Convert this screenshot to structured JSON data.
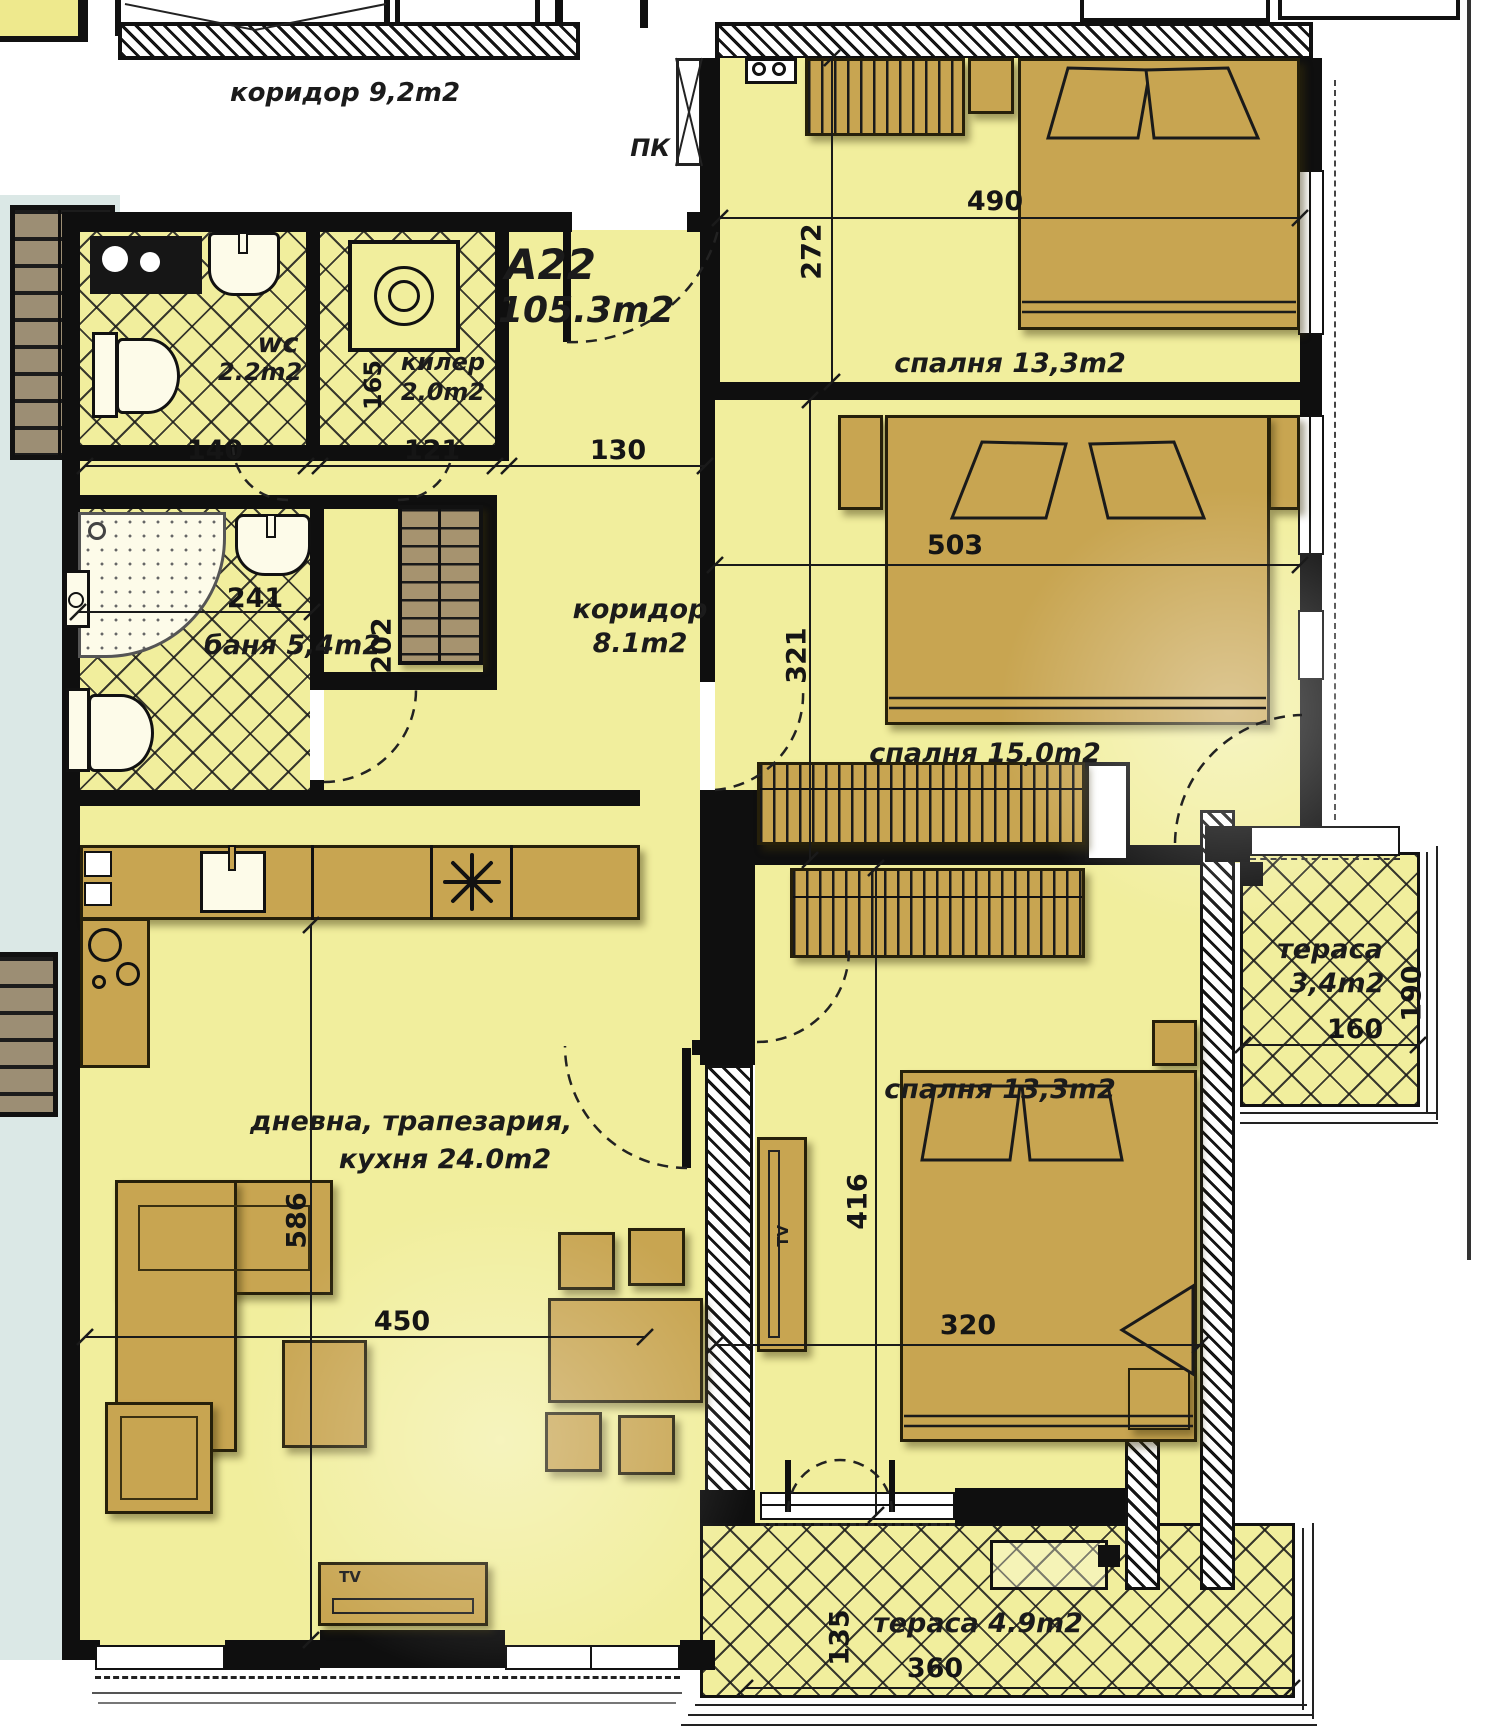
{
  "labels": {
    "title": "A22",
    "title_area": "105.3m2",
    "public_corridor": "коридор 9,2m2",
    "pk": "ПК",
    "bedroom1": "спалня 13,3m2",
    "bedroom2": "спалня 15,0m2",
    "bedroom3": "спалня 13,3m2",
    "corridor_name": "коридор",
    "corridor_area": "8.1m2",
    "wc_name": "wc",
    "wc_area": "2.2m2",
    "storage_name": "килер",
    "storage_area": "2.0m2",
    "bath": "баня 5,4m2",
    "living_line1": "дневна, трапезария,",
    "living_line2": "кухня  24.0m2",
    "terrace_right_name": "тераса",
    "terrace_right_area": "3,4m2",
    "terrace_bottom": "тераса  4.9m2",
    "tv": "TV"
  },
  "dims": {
    "bedroom1_w": "490",
    "bedroom1_h": "272",
    "bedroom2_w": "503",
    "bedroom2_h": "321",
    "bedroom3_w": "320",
    "bedroom3_h": "416",
    "corridor_w": "130",
    "wc_w": "140",
    "storage_w": "121",
    "storage_h": "165",
    "bath_w": "241",
    "bath_h": "202",
    "living_w": "450",
    "living_h": "586",
    "terrace_right_w": "160",
    "terrace_right_h": "190",
    "terrace_bottom_w": "360",
    "terrace_bottom_h": "135"
  }
}
